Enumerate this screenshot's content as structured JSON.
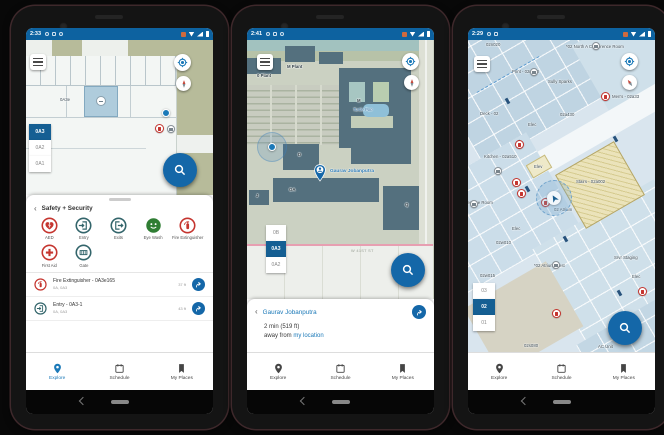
{
  "colors": {
    "status_bar": "#0d62a0",
    "accent_blue": "#1467a8",
    "link_blue": "#1b79b8",
    "floor_selected": "#155f93",
    "alert_red": "#c5352f",
    "safety_teal": "#33656b",
    "safety_green": "#2f7d33"
  },
  "phones": [
    {
      "status_time": "2:33",
      "map": {
        "room_label": "0A3e"
      },
      "floors": {
        "items": [
          "0A3",
          "0A2",
          "0A1"
        ],
        "selected": "0A3"
      },
      "sheet": {
        "back_icon": "‹",
        "header": "Safety + Security",
        "categories": [
          {
            "label": "AED",
            "icon": "aed"
          },
          {
            "label": "Entry",
            "icon": "entry"
          },
          {
            "label": "Exits",
            "icon": "exits"
          },
          {
            "label": "Eye Wash",
            "icon": "eye-wash"
          },
          {
            "label": "Fire Extinguisher",
            "icon": "fire-extinguisher"
          },
          {
            "label": "First Aid",
            "icon": "first-aid"
          },
          {
            "label": "Gate",
            "icon": "gate"
          }
        ],
        "results": [
          {
            "title": "Fire Extinguisher - 0A3e165",
            "subtitle": "0A, 0A3",
            "distance": "37 ft",
            "icon": "fire-extinguisher"
          },
          {
            "title": "Entry - 0A3-1",
            "subtitle": "0A, 0A3",
            "distance": "43 ft",
            "icon": "entry"
          }
        ]
      },
      "nav": {
        "explore": "Explore",
        "schedule": "Schedule",
        "my_places": "My Places"
      }
    },
    {
      "status_time": "2:41",
      "map": {
        "labels": {
          "m_plant": "M Plant",
          "o_plant": "0 Plant",
          "m": "M",
          "turtle": "Turtle Pon",
          "oa": "OA",
          "j": "J",
          "d": "D",
          "q": "Q",
          "street": "W 41ST ST"
        },
        "pin_label": "Gaurav Jobanputra"
      },
      "floors": {
        "items": [
          "0B",
          "0A3",
          "0A2"
        ],
        "selected": "0A3"
      },
      "sheet": {
        "back_icon": "‹",
        "title": "Gaurav Jobanputra",
        "line1": "2 min (519 ft)",
        "line2_prefix": "away from ",
        "line2_link": "my location"
      },
      "nav": {
        "explore": "Explore",
        "schedule": "Schedule",
        "my_places": "My Places"
      }
    },
    {
      "status_time": "2:29",
      "map": {
        "labels": {
          "a": "02n020",
          "b": "*02 North A Conference Room",
          "c": "Print - 02n010",
          "d": "Sully Sparks",
          "e": "Men's - 02a33",
          "f": "Deck - 02",
          "g": "02a430",
          "h": "Elec",
          "i": "Kitchen - 02a510",
          "j": "Elev",
          "k": "Stairs - 02a002",
          "l": "02 Atrium",
          "m": "Conference Room",
          "n": "Elec",
          "o": "02w010",
          "p": "*02 Atrium West",
          "q": "02w015",
          "r": "Srvr Staging",
          "s": "Elec",
          "t": "02s080",
          "u": "AC Unit"
        }
      },
      "floors": {
        "items": [
          "03",
          "02",
          "01"
        ],
        "selected": "02"
      },
      "nav": {
        "explore": "Explore",
        "schedule": "Schedule",
        "my_places": "My Places"
      }
    }
  ]
}
